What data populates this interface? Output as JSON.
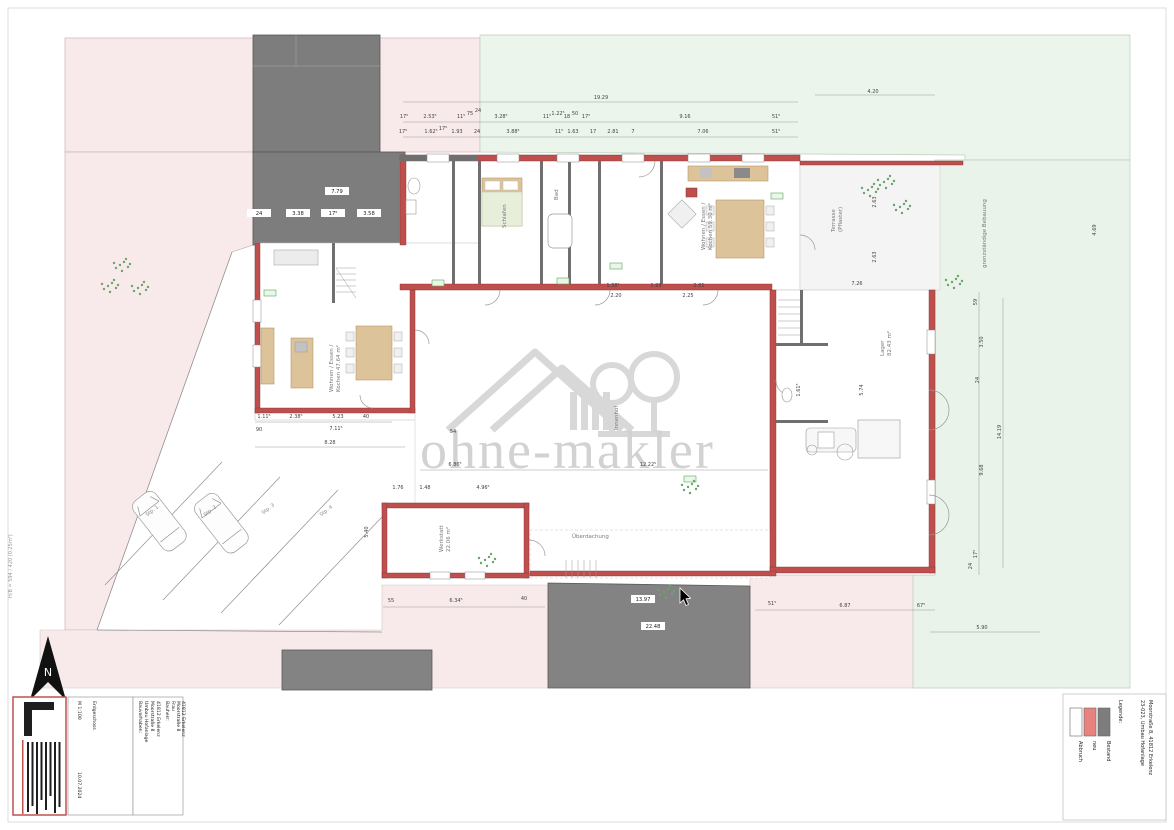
{
  "watermark": {
    "text": "ohne-makler"
  },
  "north": {
    "label": "N"
  },
  "sheet": {
    "format_label": "H/B = 594 / 420 (0.25m²)"
  },
  "titleblock": {
    "scale": "M 1:100",
    "date": "10.07.2024",
    "plan": "Erdgeschoss",
    "bv_header": "Bauvorhaben:",
    "bv1": "Umbau Hofanlage",
    "bv2": "Moorstraße 8",
    "bv3": "41812 Erkelenz",
    "bh_header": "Bauherr:",
    "bh1": "Frau",
    "bh2": "Moorstraße 8",
    "bh3": "41812 Erkelenz"
  },
  "legend": {
    "title": "Legende:",
    "ref1": "23-023, Umbau Hofanlage",
    "ref2": "Moorstraße 8, 41812 Erkelenz",
    "items": [
      {
        "label": "Bestand",
        "color": "#7d7d7d"
      },
      {
        "label": "neu",
        "color": "#e8827f"
      },
      {
        "label": "Abbruch",
        "color": "#ffffff"
      }
    ]
  },
  "rooms": [
    {
      "t": "Innenhof",
      "x": 618,
      "y": 430,
      "r": -90,
      "s": 8
    },
    {
      "t": "Wohnen / Essen /",
      "x": 333,
      "y": 392,
      "r": -90
    },
    {
      "t": "Kochen  47.64 m²",
      "x": 340,
      "y": 392,
      "r": -90
    },
    {
      "t": "Wohnen / Essen /",
      "x": 705,
      "y": 250,
      "r": -90
    },
    {
      "t": "Kochen  59.30 m²",
      "x": 712,
      "y": 250,
      "r": -90
    },
    {
      "t": "Schlafen",
      "x": 506,
      "y": 228,
      "r": -90
    },
    {
      "t": "Bad",
      "x": 558,
      "y": 200,
      "r": -90
    },
    {
      "t": "Lager",
      "x": 884,
      "y": 356,
      "r": -90
    },
    {
      "t": "82.43 m²",
      "x": 891,
      "y": 356,
      "r": -90
    },
    {
      "t": "Werkstatt",
      "x": 443,
      "y": 552,
      "r": -90
    },
    {
      "t": "22.06 m²",
      "x": 450,
      "y": 552,
      "r": -90
    },
    {
      "t": "Überdachung",
      "x": 572,
      "y": 538
    },
    {
      "t": "Terrasse",
      "x": 835,
      "y": 232,
      "r": -90
    },
    {
      "t": "(Pflaster)",
      "x": 842,
      "y": 232,
      "r": -90
    },
    {
      "t": "grenzständige Bebauung",
      "x": 986,
      "y": 268,
      "r": -90,
      "s": 4.5
    }
  ],
  "parking_labels": [
    {
      "t": "Stp. 1",
      "x": 153,
      "y": 512,
      "r": -38
    },
    {
      "t": "Stp. 2",
      "x": 211,
      "y": 512,
      "r": -38
    },
    {
      "t": "Stp. 3",
      "x": 269,
      "y": 510,
      "r": -38
    },
    {
      "t": "Stp. 4",
      "x": 327,
      "y": 512,
      "r": -38
    }
  ],
  "dimensions": [
    {
      "t": "19.29",
      "x": 601,
      "y": 99
    },
    {
      "t": "4.20",
      "x": 873,
      "y": 93
    },
    {
      "t": "17⁵",
      "x": 404,
      "y": 118
    },
    {
      "t": "2.53⁵",
      "x": 430,
      "y": 118
    },
    {
      "t": "11⁵",
      "x": 461,
      "y": 118
    },
    {
      "t": "75",
      "x": 470,
      "y": 115
    },
    {
      "t": "24",
      "x": 478,
      "y": 112
    },
    {
      "t": "3.28⁵",
      "x": 501,
      "y": 118
    },
    {
      "t": "11⁵",
      "x": 547,
      "y": 118
    },
    {
      "t": "1.22⁵",
      "x": 558,
      "y": 115
    },
    {
      "t": "18",
      "x": 567,
      "y": 118
    },
    {
      "t": "50",
      "x": 575,
      "y": 115
    },
    {
      "t": "17⁵",
      "x": 586,
      "y": 118
    },
    {
      "t": "9.16",
      "x": 685,
      "y": 118
    },
    {
      "t": "51⁵",
      "x": 776,
      "y": 118
    },
    {
      "t": "17⁵",
      "x": 403,
      "y": 133
    },
    {
      "t": "1.62⁵",
      "x": 431,
      "y": 133
    },
    {
      "t": "17⁵",
      "x": 443,
      "y": 130
    },
    {
      "t": "1.93",
      "x": 457,
      "y": 133
    },
    {
      "t": "24",
      "x": 477,
      "y": 133
    },
    {
      "t": "3.88⁵",
      "x": 513,
      "y": 133
    },
    {
      "t": "11⁵",
      "x": 559,
      "y": 133
    },
    {
      "t": "1.63",
      "x": 573,
      "y": 133
    },
    {
      "t": "17",
      "x": 593,
      "y": 133
    },
    {
      "t": "2.81",
      "x": 613,
      "y": 133
    },
    {
      "t": "7",
      "x": 633,
      "y": 133
    },
    {
      "t": "7.06",
      "x": 703,
      "y": 133
    },
    {
      "t": "51⁵",
      "x": 776,
      "y": 133
    },
    {
      "t": "59",
      "x": 977,
      "y": 302,
      "r": -90
    },
    {
      "t": "3.50",
      "x": 983,
      "y": 342,
      "r": -90
    },
    {
      "t": "24",
      "x": 979,
      "y": 380,
      "r": -90
    },
    {
      "t": "14.19",
      "x": 1001,
      "y": 432,
      "r": -90
    },
    {
      "t": "9.68",
      "x": 983,
      "y": 470,
      "r": -90
    },
    {
      "t": "17⁵",
      "x": 977,
      "y": 554,
      "r": -90
    },
    {
      "t": "24",
      "x": 972,
      "y": 566,
      "r": -90
    },
    {
      "t": "4.69",
      "x": 1096,
      "y": 230,
      "r": -90
    },
    {
      "t": "2.63",
      "x": 876,
      "y": 202,
      "r": -90
    },
    {
      "t": "2.63",
      "x": 876,
      "y": 257,
      "r": -90
    },
    {
      "t": "5.40",
      "x": 368,
      "y": 532,
      "r": -90
    },
    {
      "t": "55",
      "x": 391,
      "y": 602
    },
    {
      "t": "6.34⁵",
      "x": 456,
      "y": 602
    },
    {
      "t": "40",
      "x": 524,
      "y": 600
    },
    {
      "t": "51⁵",
      "x": 772,
      "y": 605
    },
    {
      "t": "6.87",
      "x": 845,
      "y": 607
    },
    {
      "t": "67⁵",
      "x": 921,
      "y": 607
    },
    {
      "t": "5.90",
      "x": 982,
      "y": 629
    },
    {
      "t": "90",
      "x": 259,
      "y": 431
    },
    {
      "t": "54",
      "x": 453,
      "y": 433
    },
    {
      "t": "1.11⁵",
      "x": 264,
      "y": 418
    },
    {
      "t": "2.38⁵",
      "x": 296,
      "y": 418
    },
    {
      "t": "5.23",
      "x": 338,
      "y": 418
    },
    {
      "t": "40",
      "x": 366,
      "y": 418
    },
    {
      "t": "7.11⁵",
      "x": 336,
      "y": 430
    },
    {
      "t": "8.28",
      "x": 330,
      "y": 444
    },
    {
      "t": "6.86⁵",
      "x": 455,
      "y": 466
    },
    {
      "t": "12.22⁵",
      "x": 648,
      "y": 466
    },
    {
      "t": "1.76",
      "x": 398,
      "y": 489
    },
    {
      "t": "1.48",
      "x": 425,
      "y": 489
    },
    {
      "t": "4.96⁵",
      "x": 483,
      "y": 489
    },
    {
      "t": "1.38⁵",
      "x": 613,
      "y": 287
    },
    {
      "t": "1.99",
      "x": 656,
      "y": 287
    },
    {
      "t": "2.01",
      "x": 699,
      "y": 287
    },
    {
      "t": "2.20",
      "x": 616,
      "y": 297
    },
    {
      "t": "2.25",
      "x": 688,
      "y": 297
    },
    {
      "t": "7.26",
      "x": 857,
      "y": 285
    },
    {
      "t": "5.74",
      "x": 863,
      "y": 390,
      "r": -90
    },
    {
      "t": "1.61⁵",
      "x": 800,
      "y": 390,
      "r": -90
    }
  ],
  "box_dimensions": [
    {
      "t": "7.79",
      "x": 337,
      "y": 193,
      "bg": true
    },
    {
      "t": "24",
      "x": 259,
      "y": 215,
      "bg": true
    },
    {
      "t": "3.38",
      "x": 298,
      "y": 215,
      "bg": true
    },
    {
      "t": "17⁵",
      "x": 333,
      "y": 215,
      "bg": true
    },
    {
      "t": "3.58",
      "x": 369,
      "y": 215,
      "bg": true
    },
    {
      "t": "13.97",
      "x": 643,
      "y": 601,
      "bg": true
    },
    {
      "t": "22.48",
      "x": 653,
      "y": 628,
      "bg": true
    }
  ],
  "plants": [
    {
      "x": 120,
      "y": 265
    },
    {
      "x": 138,
      "y": 288
    },
    {
      "x": 108,
      "y": 286
    },
    {
      "x": 868,
      "y": 190
    },
    {
      "x": 900,
      "y": 207
    },
    {
      "x": 884,
      "y": 182
    },
    {
      "x": 688,
      "y": 487
    },
    {
      "x": 664,
      "y": 592
    },
    {
      "x": 485,
      "y": 560
    },
    {
      "x": 952,
      "y": 282
    }
  ]
}
